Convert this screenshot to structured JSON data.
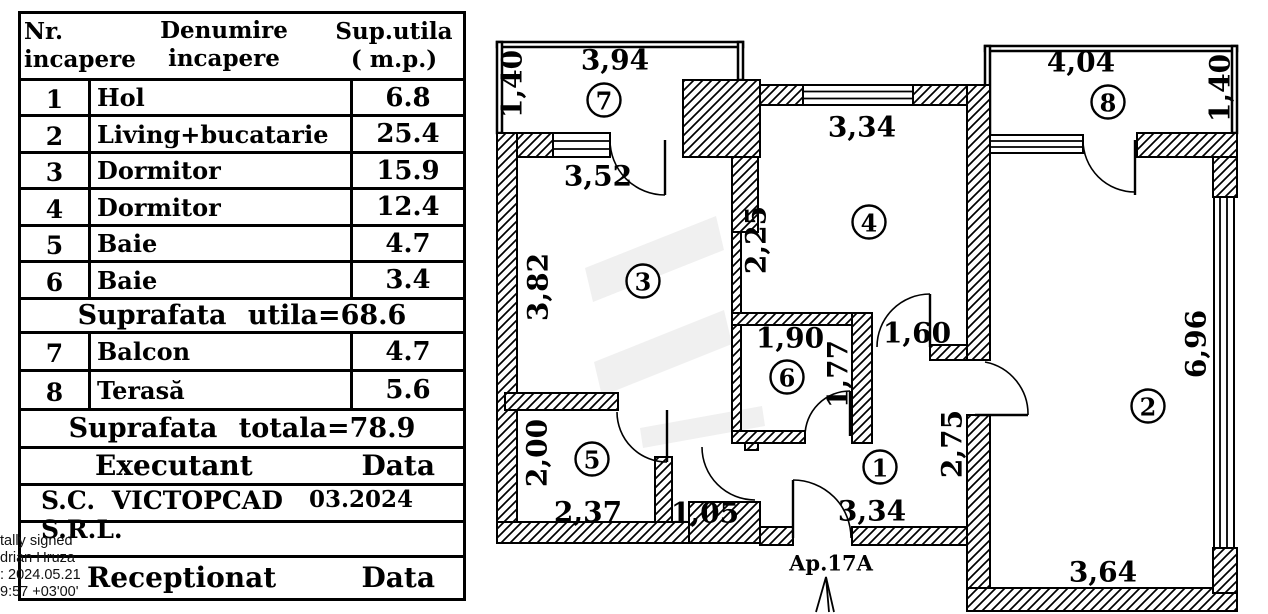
{
  "table": {
    "header": {
      "nr_line1": "Nr.",
      "nr_line2": "incapere",
      "name_line1": "Denumire",
      "name_line2": "incapere",
      "area_line1": "Sup.utila",
      "area_line2": "( m.p.)"
    },
    "rows": [
      {
        "nr": "1",
        "name": "Hol",
        "area": "6.8"
      },
      {
        "nr": "2",
        "name": "Living+bucatarie",
        "area": "25.4"
      },
      {
        "nr": "3",
        "name": "Dormitor",
        "area": "15.9"
      },
      {
        "nr": "4",
        "name": "Dormitor",
        "area": "12.4"
      },
      {
        "nr": "5",
        "name": "Baie",
        "area": "4.7"
      },
      {
        "nr": "6",
        "name": "Baie",
        "area": "3.4"
      }
    ],
    "subtotal": "Suprafata utila=68.6",
    "annex_rows": [
      {
        "nr": "7",
        "name": "Balcon",
        "area": "4.7"
      },
      {
        "nr": "8",
        "name": "Terasă",
        "area": "5.6"
      }
    ],
    "total": "Suprafata totala=78.9",
    "executant": {
      "label": "Executant",
      "data": "Data"
    },
    "company": {
      "name": "S.C. VICTOPCAD S.R.L.",
      "date": "03.2024"
    },
    "receptionat": {
      "label": "Receptionat",
      "data": "Data"
    }
  },
  "signature": {
    "line1": "tally signed",
    "line2": "drian Hruza",
    "line3": ": 2024.05.21",
    "line4": "9:57 +03'00'"
  },
  "plan": {
    "entrance": "Ap.17A",
    "rooms": {
      "r1": "1",
      "r2": "2",
      "r3": "3",
      "r4": "4",
      "r5": "5",
      "r6": "6",
      "r7": "7",
      "r8": "8"
    },
    "dims": {
      "balcony_width": "3,94",
      "balcony_depth": "1,40",
      "room3_door": "3,52",
      "room3_height": "3,82",
      "room4_width": "3,34",
      "room4_left": "2,25",
      "terrace_width": "4,04",
      "terrace_depth": "1,40",
      "room2_height": "6,96",
      "room2_width": "3,64",
      "room6_width": "1,90",
      "room6_height": "1,77",
      "hall_door": "1,60",
      "hall_right": "2,75",
      "room5_height": "2,00",
      "room5_width": "2,37",
      "corridor_width": "1,05",
      "hall_width": "3,34"
    }
  }
}
